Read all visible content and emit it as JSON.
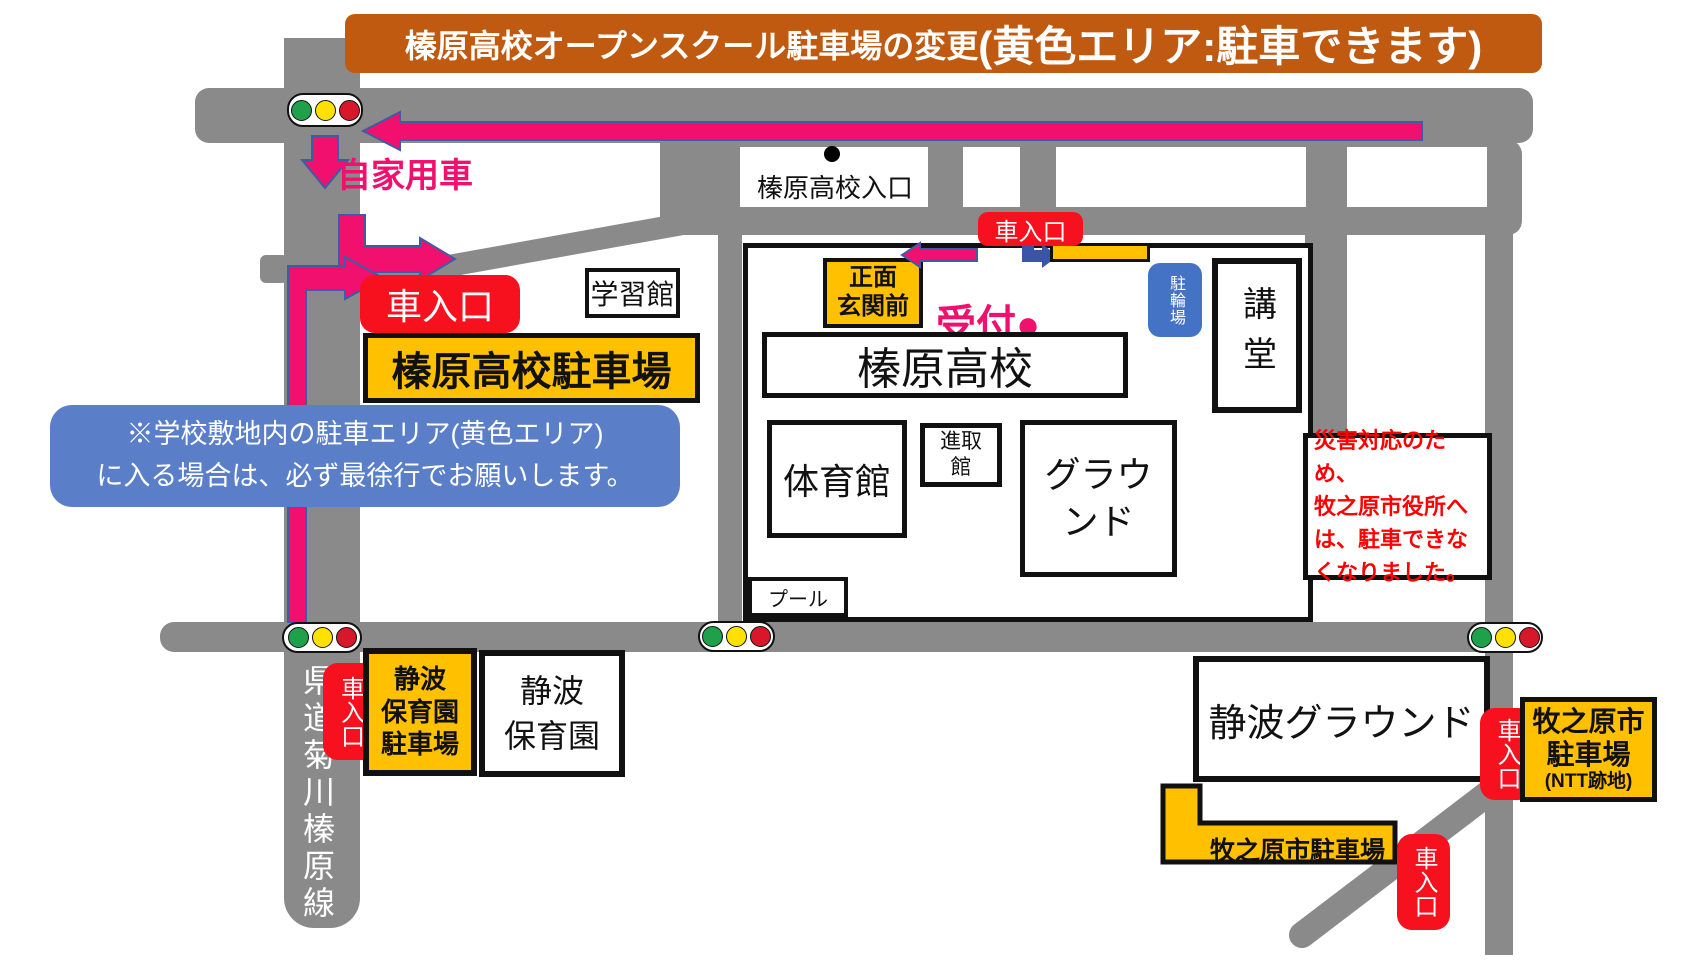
{
  "banner": {
    "title_main": "榛原高校オープンスクール駐車場の変更",
    "title_emphasis": "(黄色エリア:駐車できます)"
  },
  "route_labels": {
    "private_car": "自家用車",
    "car_entrance": "車入口",
    "reception": "受付●"
  },
  "school_area": {
    "campus_parking": "榛原高校駐車場",
    "learning_hall": "学習館",
    "bus_stop": "榛原高校入口",
    "front_entrance_line1": "正面",
    "front_entrance_line2": "玄関前",
    "bicycle_parking": "駐輪場",
    "auditorium": "講堂",
    "main_building": "榛原高校",
    "gymnasium": "体育館",
    "shinshu_hall_line1": "進取",
    "shinshu_hall_line2": "館",
    "ground_line1": "グラウ",
    "ground_line2": "ンド",
    "pool": "プール"
  },
  "notes": {
    "speed_note_line1": "※学校敷地内の駐車エリア(黄色エリア)",
    "speed_note_line2": "に入る場合は、必ず最徐行でお願いします。",
    "warning_line1": "災害対応のため、",
    "warning_line2": "牧之原市役所へ",
    "warning_line3": "は、駐車できな",
    "warning_line4": "くなりました。"
  },
  "south_area": {
    "prefectural_road": "県道菊川榛原線",
    "nursery_parking_line1": "静波",
    "nursery_parking_line2": "保育園",
    "nursery_parking_line3": "駐車場",
    "nursery_line1": "静波",
    "nursery_line2": "保育園",
    "shizunami_ground": "静波グラウンド",
    "city_parking": "牧之原市駐車場",
    "city_parking_ntt_line1": "牧之原市",
    "city_parking_ntt_line2": "駐車場",
    "city_parking_ntt_line3": "(NTT跡地)"
  },
  "colors": {
    "banner_bg": "#C05A11",
    "road_gray": "#8A8A8A",
    "parking_yellow": "#FFC000",
    "entrance_red": "#F7101E",
    "route_pink": "#F2106E",
    "route_outline_blue": "#3E5CA6",
    "note_blue": "#5B7EC9",
    "bicycle_blue": "#4472C4",
    "warning_red": "#FF0000",
    "signal_green": "#1FA04A",
    "signal_yellow": "#FFE100",
    "signal_red": "#D7182A"
  }
}
